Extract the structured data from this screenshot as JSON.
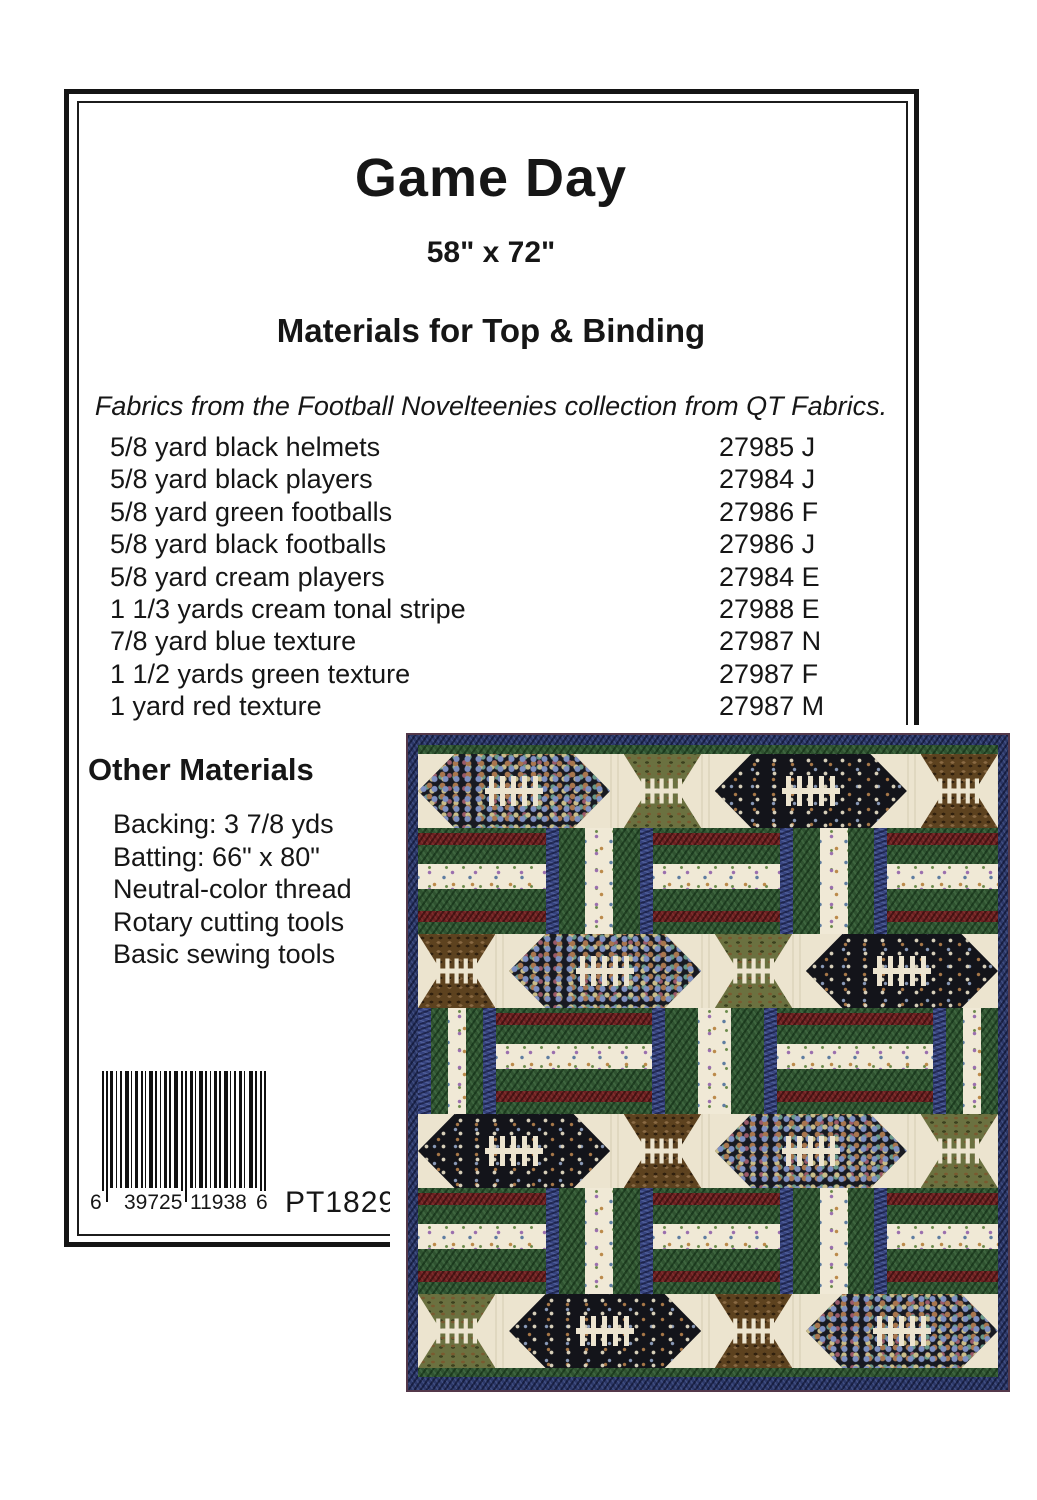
{
  "pattern_sheet": {
    "title": "Game Day",
    "dimensions": "58\" x 72\"",
    "materials_heading": "Materials for Top & Binding",
    "fabrics_note": "Fabrics from the Football Novelteenies collection from QT Fabrics.",
    "materials": [
      {
        "item": "5/8 yard black helmets",
        "code": "27985 J"
      },
      {
        "item": "5/8 yard black players",
        "code": "27984 J"
      },
      {
        "item": "5/8 yard green footballs",
        "code": "27986 F"
      },
      {
        "item": "5/8 yard black footballs",
        "code": "27986 J"
      },
      {
        "item": "5/8 yard cream players",
        "code": "27984 E"
      },
      {
        "item": "1 1/3 yards cream tonal stripe",
        "code": "27988 E"
      },
      {
        "item": "7/8 yard blue texture",
        "code": "27987 N"
      },
      {
        "item": "1 1/2 yards green texture",
        "code": "27987 F"
      },
      {
        "item": "1 yard red texture",
        "code": "27987 M"
      }
    ],
    "other_materials_heading": "Other Materials",
    "other_materials": [
      "Backing: 3 7/8 yds",
      "Batting: 66\" x 80\"",
      "Neutral-color thread",
      "Rotary cutting tools",
      "Basic sewing tools"
    ],
    "barcode": {
      "left_digit": "6",
      "group1": "39725",
      "group2": "11938",
      "right_digit": "6",
      "pattern_number": "PT1829"
    }
  },
  "quilt_photo": {
    "description": "Game Day football quilt: rows of pieced footballs on cream alternating with green rail-fence rows",
    "colors": {
      "binding_navy": "#2b3767",
      "edge_maroon": "#53384a",
      "field_green": "#2f5230",
      "rail_red": "#6d2021",
      "bar_blue": "#36437e",
      "background_cream": "#ece4cf",
      "helmets_print_bg": "#181a22",
      "players_print_bg": "#13141a",
      "footballs_brown_bg": "#5d421f",
      "footballs_green_bg": "#6b7140",
      "laces_cream": "#ece4cf"
    },
    "rows": [
      {
        "type": "football",
        "blocks": [
          "helmets",
          "footballs_green",
          "players_black",
          "footballs_brown"
        ]
      },
      {
        "type": "rails",
        "variant": 1
      },
      {
        "type": "football",
        "blocks": [
          "footballs_brown",
          "helmets",
          "footballs_green",
          "players_black"
        ]
      },
      {
        "type": "rails",
        "variant": 2
      },
      {
        "type": "football",
        "blocks": [
          "players_black",
          "footballs_brown",
          "helmets",
          "footballs_green"
        ]
      },
      {
        "type": "rails",
        "variant": 1
      },
      {
        "type": "football",
        "blocks": [
          "footballs_green",
          "players_black",
          "footballs_brown",
          "helmets"
        ]
      }
    ]
  }
}
